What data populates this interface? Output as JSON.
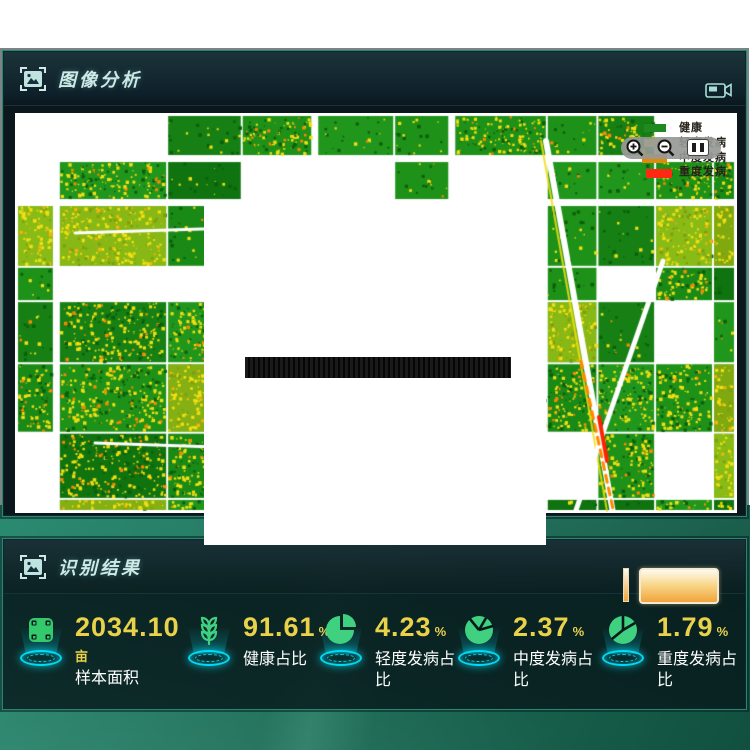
{
  "image_analysis": {
    "title": "图像分析",
    "legend": [
      {
        "label": "健康",
        "color": "#1f8a1f"
      },
      {
        "label": "轻度发病",
        "color": "#ffe23a"
      },
      {
        "label": "中度发病",
        "color": "#e0890a"
      },
      {
        "label": "重度发病",
        "color": "#ff2812"
      }
    ]
  },
  "recognition_results": {
    "title": "识别结果",
    "stats": [
      {
        "value": "2034.10",
        "unit": "亩",
        "label": "样本面积"
      },
      {
        "value": "91.61",
        "unit": "%",
        "label": "健康占比"
      },
      {
        "value": "4.23",
        "unit": "%",
        "label": "轻度发病占比"
      },
      {
        "value": "2.37",
        "unit": "%",
        "label": "中度发病占比"
      },
      {
        "value": "1.79",
        "unit": "%",
        "label": "重度发病占比"
      }
    ]
  },
  "colors": {
    "value_text": "#e9d24a",
    "pedestal_glow": "#00e5ff",
    "stat_icon_green": "#3fd080",
    "map_healthy": "#1a8a17",
    "map_mild_disease": "#f2df12",
    "map_moderate_disease": "#ff8800",
    "map_severe_disease": "#ff2200"
  }
}
